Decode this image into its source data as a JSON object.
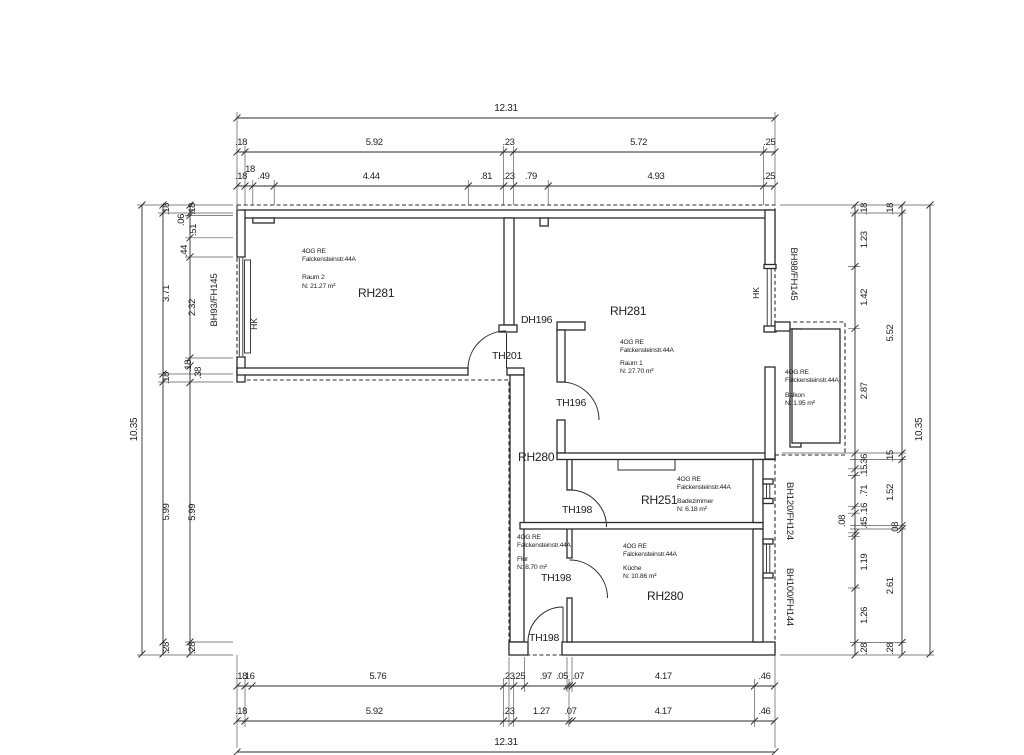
{
  "unit": {
    "line1": "4OG RE",
    "line2": "Falckensteinstr.44A"
  },
  "rooms": {
    "raum2": {
      "label": "RH281",
      "name": "Raum 2",
      "area": "N: 21.27 m²"
    },
    "raum1": {
      "label": "RH281",
      "name": "Raum 1",
      "area": "N: 27.70 m²"
    },
    "flur": {
      "label": "RH280",
      "name": "Flur",
      "area": "N: 8.70 m²"
    },
    "bad": {
      "label": "RH251",
      "name": "Badezimmer",
      "area": "N: 6.18 m²"
    },
    "kueche": {
      "label": "RH280",
      "name": "Küche",
      "area": "N: 10.86 m²"
    },
    "balkon": {
      "name": "Balkon",
      "area": "N: 1.95 m²"
    }
  },
  "doors": {
    "dh196": "DH196",
    "th201": "TH201",
    "th196": "TH196",
    "th198": "TH198"
  },
  "windows": {
    "left": "BH93/FH145",
    "right": "BH98/FH145",
    "bath": "BH120/FH124",
    "kitchen": "BH100/FH144"
  },
  "radiator": "HK",
  "dimensions": {
    "top": {
      "total": "12.31",
      "row2": [
        ".18",
        "5.92",
        ".23",
        "5.72",
        ".25"
      ],
      "row3": [
        ".18",
        "18",
        ".49",
        "4.44",
        ".81",
        ".23",
        ".79",
        "4.93",
        ".25"
      ]
    },
    "bottom": {
      "row1": [
        ".18",
        ".16",
        "5.76",
        ".23",
        ".25",
        ".97",
        ".05",
        ".07",
        "4.17",
        ".46"
      ],
      "row2": [
        ".18",
        "5.92",
        ".23",
        "1.27",
        ".07",
        "4.17",
        ".46"
      ],
      "total": "12.31"
    },
    "left": {
      "total": "10.35",
      "col2": [
        ".18",
        "3.71",
        ".18",
        "5.99",
        ".28"
      ],
      "col3": [
        ".18",
        ".06",
        ".51",
        ".44",
        "2.32",
        ".18",
        ".38",
        "5.99",
        ".28"
      ]
    },
    "right": {
      "total": "10.35",
      "inner": [
        ".18",
        "1.23",
        "1.42",
        "2.87",
        ".36",
        ".15",
        ".71",
        ".16",
        ".45",
        ".08",
        "1.19",
        "1.26",
        ".28"
      ],
      "mid": [
        ".18",
        "5.52",
        ".15",
        "1.52",
        ".08",
        "2.61",
        ".28"
      ]
    }
  }
}
